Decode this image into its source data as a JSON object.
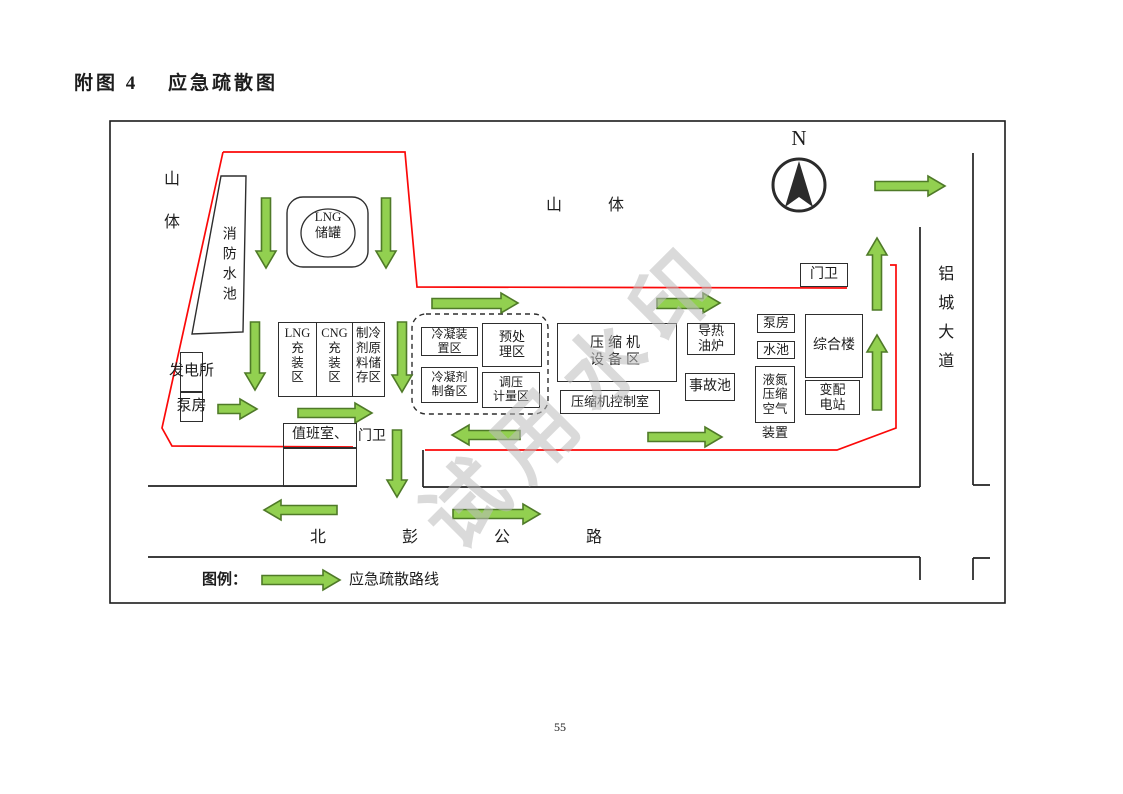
{
  "page": {
    "title": "附图 4　 应急疏散图",
    "page_number": "55"
  },
  "map": {
    "north_label": "N",
    "terrain": {
      "mountain_left": "山\n体",
      "mountain_center": "山体"
    },
    "roads": {
      "south_road": "北彭公路",
      "east_road": "铝城大道"
    },
    "facilities": {
      "fire_pool": "消防水池",
      "lng_tank": "LNG\n储罐",
      "power_station": "发电所",
      "pump_house_left": "泵房",
      "lng_filling": "LNG\n充\n装\n区",
      "cng_filling": "CNG\n充\n装\n区",
      "refrigerant_storage": "制冷\n剂原\n料储\n存区",
      "condenser_area": "冷凝装\n置区",
      "pretreatment_area": "预处\n理区",
      "condensate_prep_area": "冷凝剂\n制备区",
      "metering_area": "调压\n计量区",
      "compressor_area": "压缩机\n设备区",
      "compressor_control_room": "压缩机控制室",
      "oil_furnace": "导热\n油炉",
      "accident_pool": "事故池",
      "duty_room": "值班室、",
      "gate_south": "门卫",
      "gate_north": "门卫",
      "pump_house_right": "泵房",
      "water_pool": "水池",
      "nitrogen_air_unit": "液氮\n压缩\n空气",
      "nitrogen_air_unit_suffix": "装置",
      "office_building": "综合楼",
      "substation": "变配\n电站"
    },
    "legend": {
      "label": "图例：",
      "route_label": "应急疏散路线"
    },
    "watermark": "试用水印",
    "colors": {
      "route_green": "#92d050",
      "route_outline": "#4f7a28",
      "boundary_red": "#fb0909"
    }
  }
}
